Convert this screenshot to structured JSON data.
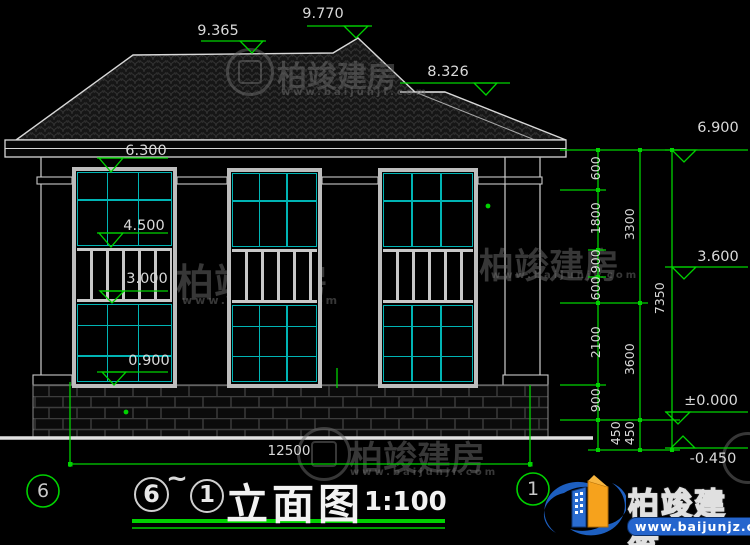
{
  "watermark": {
    "name": "柏竣建房",
    "url": "www.baijunjf.com"
  },
  "logo": {
    "name": "柏竣建筑",
    "url": "www.baijunjz.com"
  },
  "elevations": {
    "roof": [
      "9.365",
      "9.770",
      "8.326"
    ],
    "left": [
      "6.300",
      "4.500",
      "3.000",
      "0.900"
    ],
    "right": [
      "6.900",
      "3.600",
      "±0.000",
      "-0.450"
    ]
  },
  "chains": {
    "inner": [
      "600",
      "1800",
      "900",
      "600",
      "2100",
      "900",
      "450"
    ],
    "middle": [
      "3300",
      "3600",
      "450"
    ],
    "outer": [
      "7350"
    ],
    "bottom": "12500"
  },
  "axes": {
    "left": "6",
    "right": "1"
  },
  "title_block": {
    "axis_from": "6",
    "separator": "~",
    "axis_to": "1",
    "name": "立面图",
    "scale": "1:100"
  }
}
